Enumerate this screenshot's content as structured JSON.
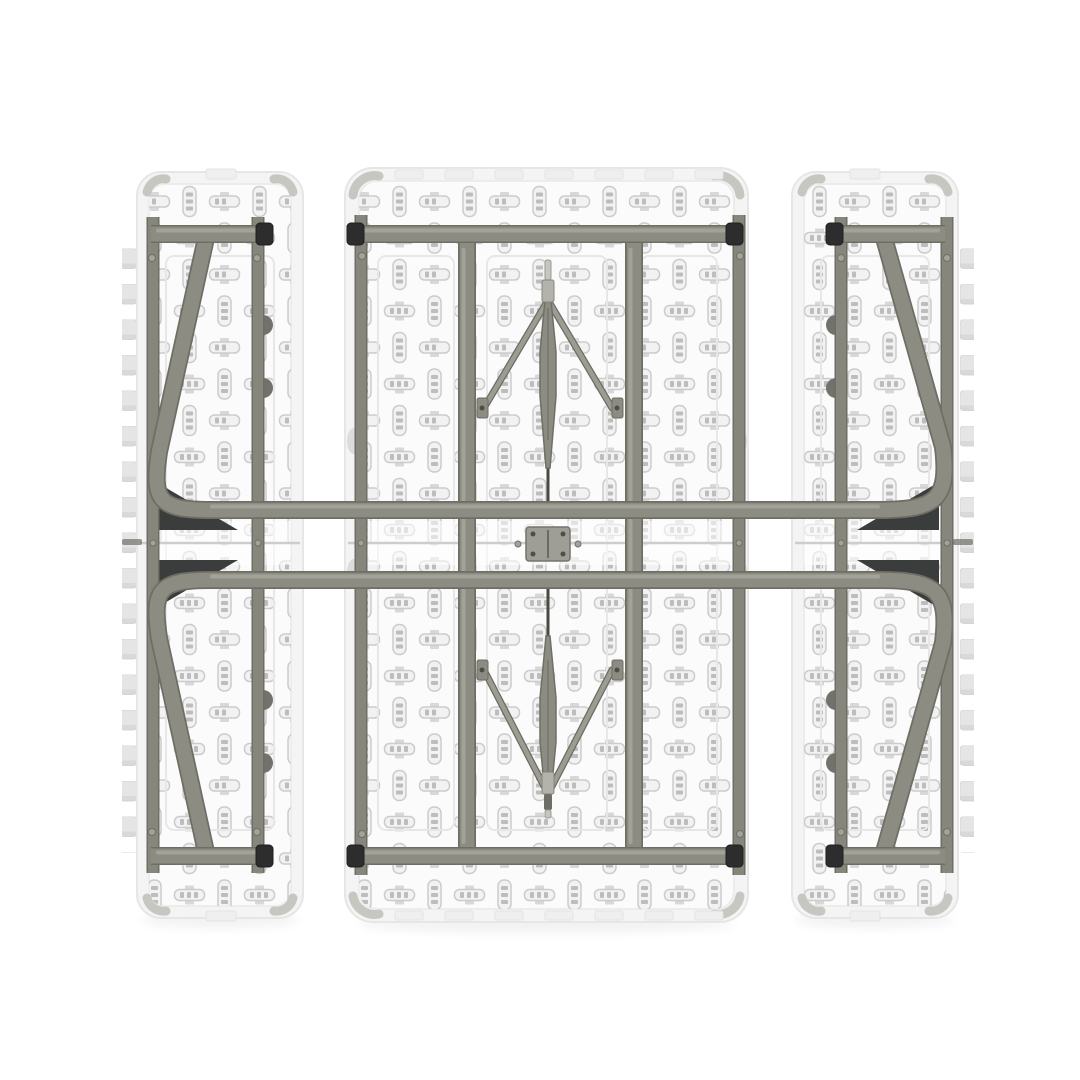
{
  "alt": "Top-down view of a white folded picnic table underside: a wide fold-in-half tabletop panel between two narrow bench panels, all with embossed capsule texture and scalloped outer edges, overlaid by a folded olive-gray steel tube frame with perimeter rails, two long cross tubes through the middle fold, chevron folding leg braces with a center hinge plate, and dark corner gusset plates",
  "colors": {
    "background": "#ffffff",
    "panel-face": "#f4f4f4",
    "panel-edge": "#e6e6e6",
    "panel-floor": "#fbfbfb",
    "panel-inner-edge": "#ececec",
    "molding": "#e7e7e7",
    "seam": "#cdcdcd",
    "seam-tick": "#6f6f68",
    "tooth": "#e5e5e5",
    "corner-detail": "#c7c7c2",
    "slot": "#efefef",
    "lug": "#72726a",
    "lug-light": "#dcdcdc",
    "gusset": "#3b3c3c",
    "tube": "#8c8c83",
    "tube-edge": "#6e6e65",
    "tube-highlight": "#a6a69d",
    "rail": "#86867d",
    "cap": "#2d2d2d",
    "strut": "#9c9c93",
    "hinge-plate": "#9e9e96",
    "emboss-stroke": "#c9c9c9",
    "emboss-fill": "#f1f1f1",
    "emboss-mark": "#bababa"
  },
  "parts": {
    "panels": [
      "left-bench",
      "table-top",
      "right-bench"
    ],
    "frame": [
      "top-rails",
      "bottom-rails",
      "side-rails",
      "inner-leg-tubes",
      "upper-folded-leg",
      "lower-folded-leg",
      "chevron-brace-upper",
      "chevron-brace-lower",
      "center-hinge-plate",
      "corner-gussets"
    ],
    "bench_count": 2,
    "scallop_teeth_per_bench": 18,
    "gusset_count": 4,
    "rail_end_caps": 8
  }
}
